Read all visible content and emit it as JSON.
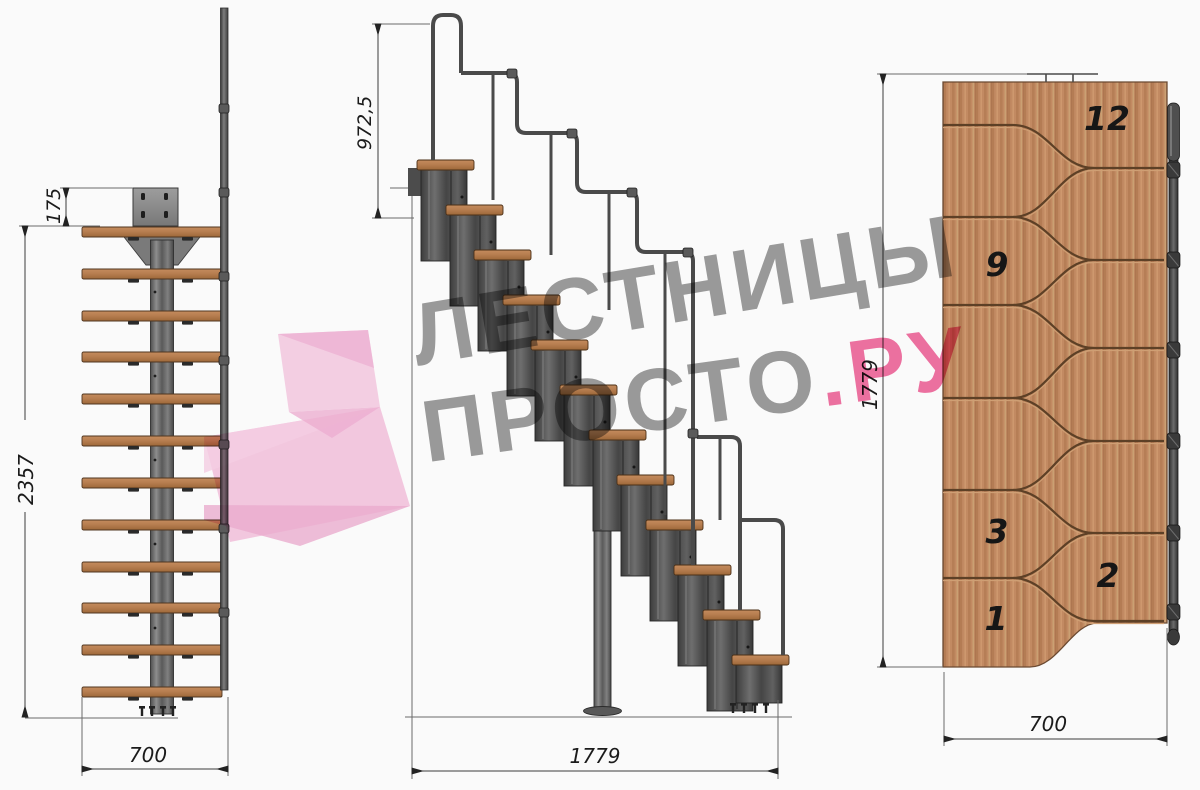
{
  "drawing": {
    "subject": "modular staircase technical drawing",
    "watermark": {
      "line1": "ЛЕСТНИЦЫ",
      "line2_gray": "ПРОСТО",
      "line2_pink": ".РУ"
    },
    "front_view": {
      "dim_top_offset": "175",
      "dim_total_height": "2357",
      "dim_width": "700"
    },
    "side_view": {
      "dim_handrail_height": "972,5",
      "dim_total_length": "1779"
    },
    "plan_view": {
      "dim_total_length": "1779",
      "dim_width": "700",
      "step_labels": [
        "12",
        "9",
        "3",
        "2",
        "1"
      ]
    },
    "colors": {
      "accent_pink": "#ee5e95",
      "logo_pink_light": "#f6bedd",
      "watermark_gray": "#8e8e8e",
      "wood": "#c28a62",
      "metal_dark": "#4a4a4a",
      "background": "#fafafa"
    }
  }
}
